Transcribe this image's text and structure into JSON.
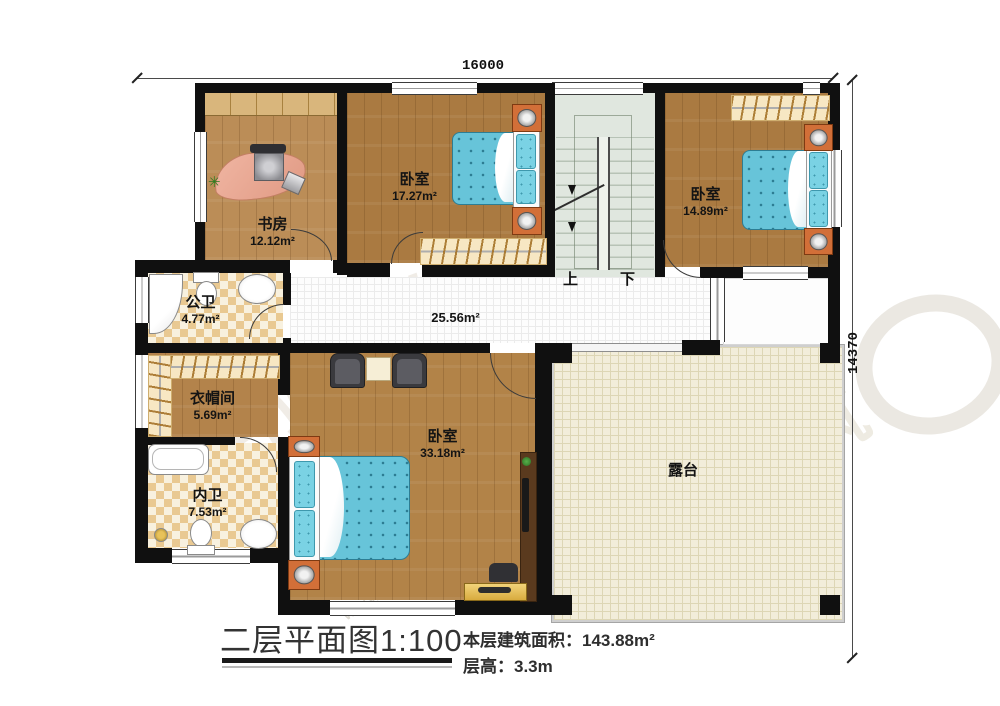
{
  "plan": {
    "dimensions": {
      "top": "16000",
      "right": "14370"
    },
    "rooms": {
      "study": {
        "name": "书房",
        "area": "12.12m²"
      },
      "bedroom_a": {
        "name": "卧室",
        "area": "17.27m²"
      },
      "bedroom_b": {
        "name": "卧室",
        "area": "14.89m²"
      },
      "master": {
        "name": "卧室",
        "area": "33.18m²"
      },
      "public_bath": {
        "name": "公卫",
        "area": "4.77m²"
      },
      "cloakroom": {
        "name": "衣帽间",
        "area": "5.69m²"
      },
      "private_bath": {
        "name": "内卫",
        "area": "7.53m²"
      },
      "corridor": {
        "area": "25.56m²"
      },
      "terrace": {
        "name": "露台"
      }
    },
    "stairs": {
      "up": "上",
      "down": "下"
    }
  },
  "footer": {
    "title": "二层平面图1:100",
    "area_label": "本层建筑面积：143.88m²",
    "height_label": "层高：3.3m"
  },
  "watermark": {
    "brand": "柏竣建筑",
    "url": "www.baijunjz.com"
  },
  "palette": {
    "wall": "#101010",
    "wood": "#b3834b",
    "bed": "#67c4d9",
    "terrace": "#f2edda",
    "checker": "#e9c992",
    "stairs": "#e0e7df"
  }
}
